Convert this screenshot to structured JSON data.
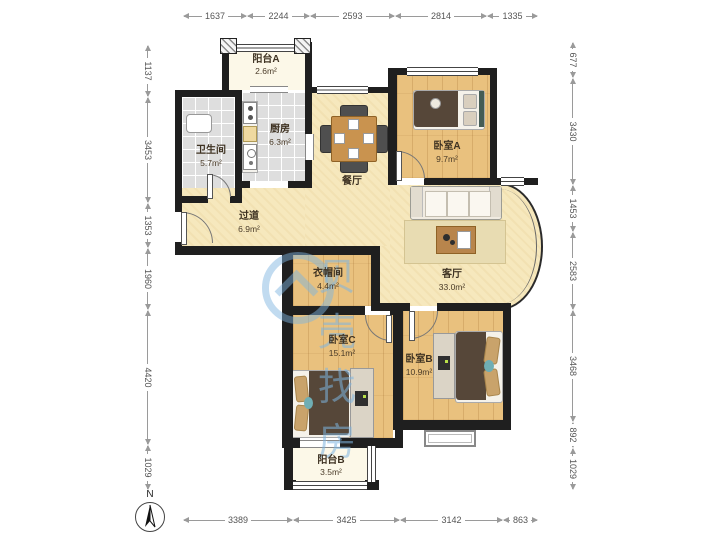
{
  "watermark": {
    "text": "贝壳找房",
    "color": "#7EB4E0"
  },
  "compass": {
    "label": "N"
  },
  "rooms": {
    "balcony_a": {
      "name": "阳台A",
      "area": "2.6m²"
    },
    "kitchen": {
      "name": "厨房",
      "area": "6.3m²"
    },
    "bathroom": {
      "name": "卫生间",
      "area": "5.7m²"
    },
    "bedroom_a": {
      "name": "卧室A",
      "area": "9.7m²"
    },
    "dining": {
      "name": "餐厅"
    },
    "hallway": {
      "name": "过道",
      "area": "6.9m²"
    },
    "cloakroom": {
      "name": "衣帽间",
      "area": "4.4m²"
    },
    "living": {
      "name": "客厅",
      "area": "33.0m²"
    },
    "bedroom_c": {
      "name": "卧室C",
      "area": "15.1m²"
    },
    "bedroom_b": {
      "name": "卧室B",
      "area": "10.9m²"
    },
    "balcony_b": {
      "name": "阳台B",
      "area": "3.5m²"
    }
  },
  "dimensions": {
    "top": [
      "1637",
      "2244",
      "2593",
      "2814",
      "1335"
    ],
    "left": [
      "1137",
      "3453",
      "1353",
      "1960",
      "4420",
      "1029"
    ],
    "right": [
      "677",
      "3430",
      "1453",
      "2583",
      "3468",
      "892",
      "1029"
    ],
    "bottom": [
      "3389",
      "3425",
      "3142",
      "863"
    ]
  },
  "colors": {
    "wall": "#1F1F1F",
    "wood_floor": "#E9C17E",
    "open_floor": "#F6E8BD",
    "tile_floor": "#DEDEDE",
    "balcony_floor": "#FCF8E8",
    "watermark_blue": "#7EB4E0"
  }
}
